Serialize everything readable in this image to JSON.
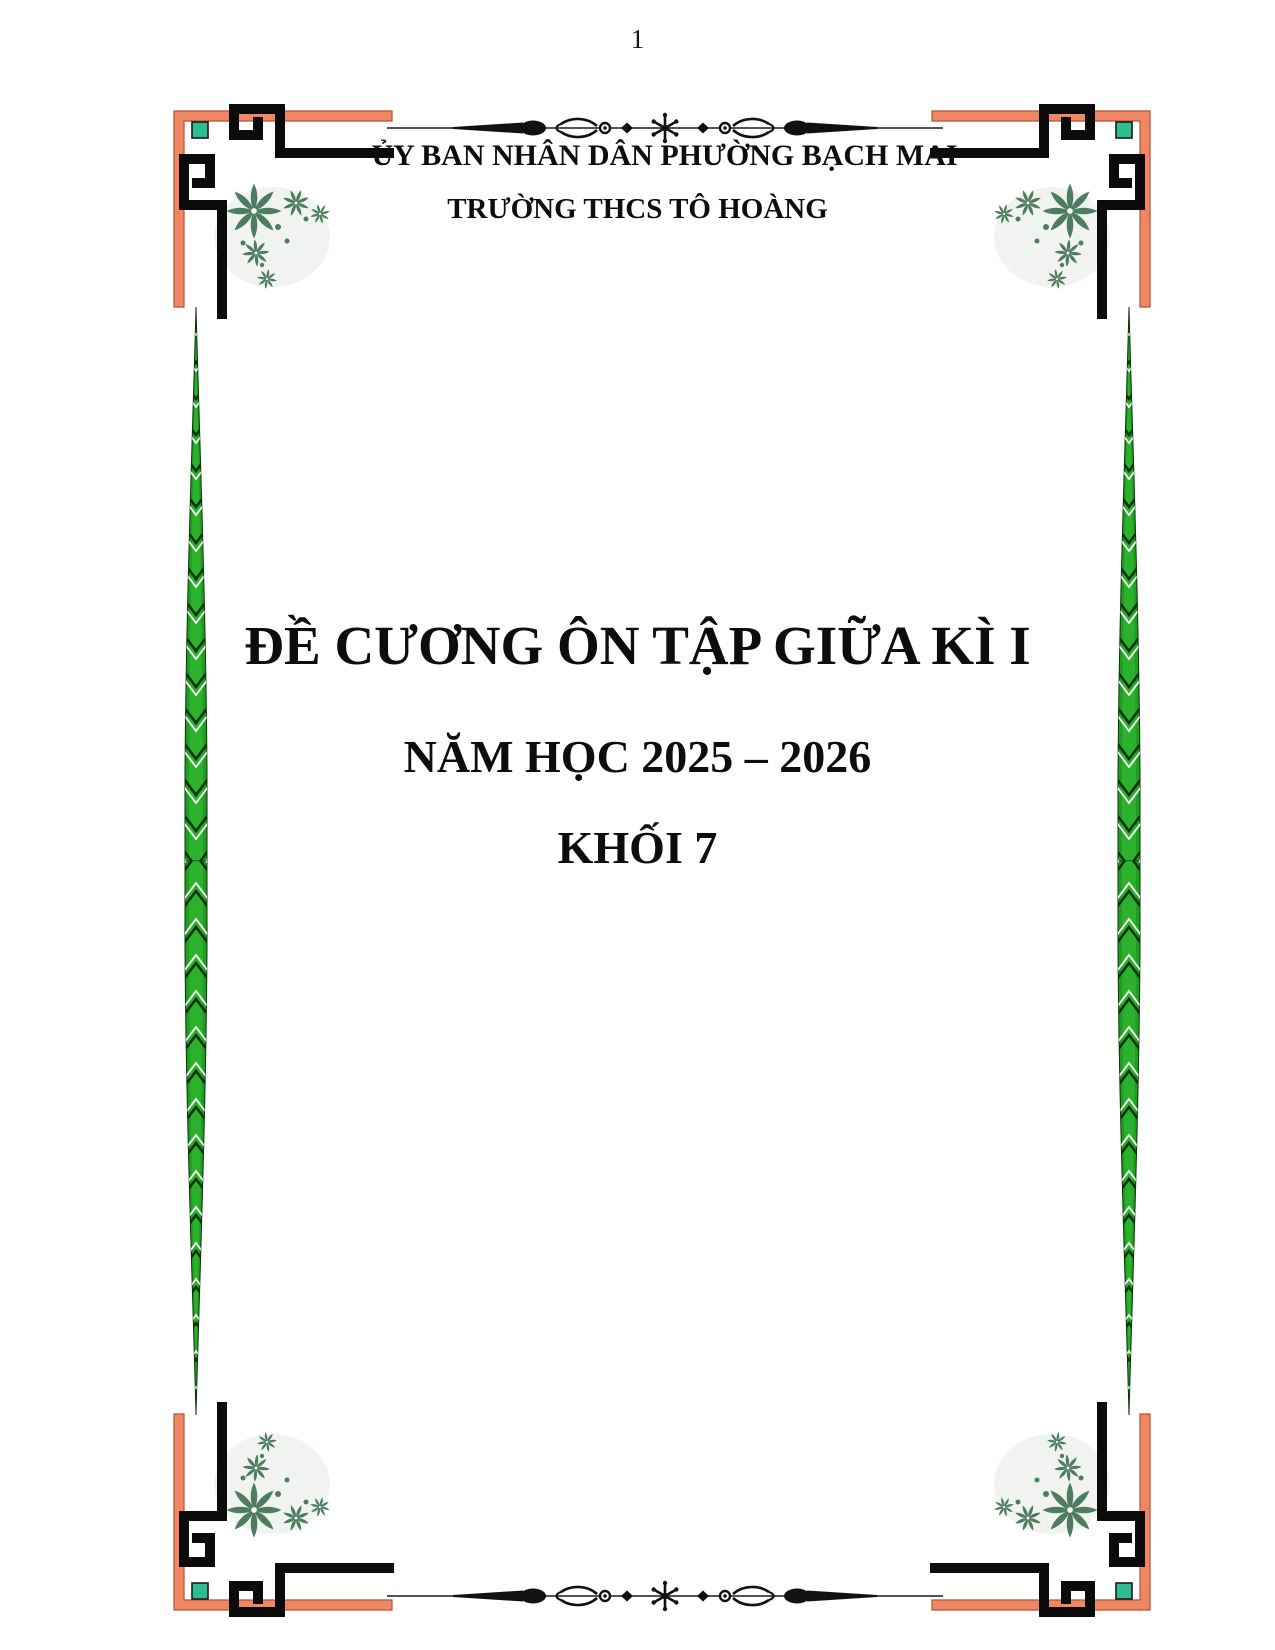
{
  "page": {
    "number": "1"
  },
  "header": {
    "line1": "ỦY BAN NHÂN DÂN PHƯỜNG BẠCH MAI",
    "line2": "TRƯỜNG THCS TÔ HOÀNG"
  },
  "title": {
    "line1": "ĐỀ CƯƠNG ÔN TẬP GIỮA KÌ I",
    "line2": "NĂM HỌC 2025 – 2026",
    "line3": "KHỐI 7"
  },
  "decorations": {
    "corner_ornament": "greek-key-meander-corner with poinsettia floral cluster and teal square",
    "side_border": "green-leaf-vine vertical border",
    "divider": "calligraphic ornamental divider with central asterisk, scrolls and spear finials"
  },
  "colors": {
    "salmon_border": "#EF8765",
    "salmon_edge": "#B4522E",
    "teal_square": "#2EBD92",
    "floral_green": "#4E7C5F",
    "vine_green": "#1F9E20",
    "vine_dark": "#0A330A",
    "ornament_black": "#0B0B0B",
    "text_ink": "#0D0D0D"
  }
}
